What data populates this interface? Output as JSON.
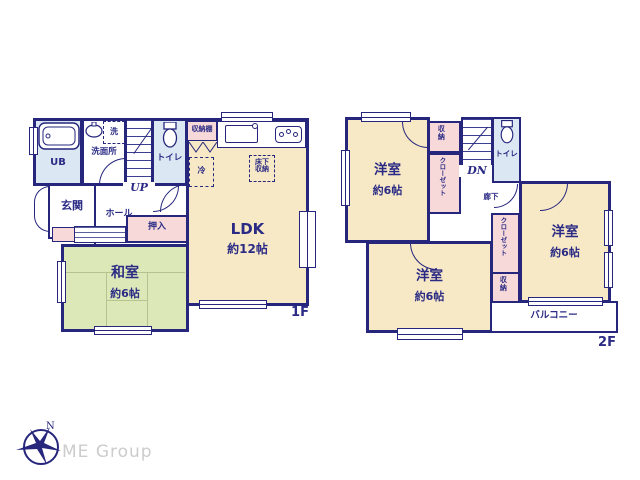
{
  "colors": {
    "wall_navy": "#26267d",
    "text_navy": "#2b2b85",
    "room_cream": "#f7e9c6",
    "tatami_green": "#dde8b9",
    "closet_pink": "#f7d9d9",
    "bath_blue": "#dbe8f4",
    "logo_gray": "#cccccc"
  },
  "floor1": {
    "floor_label": "1F",
    "rooms": {
      "ub": {
        "label": "UB"
      },
      "washroom": {
        "label": "洗面所"
      },
      "washer": {
        "label": "洗"
      },
      "toilet": {
        "label": "トイレ"
      },
      "stairs_label": "UP",
      "shelf": {
        "label": "収納棚"
      },
      "fridge": {
        "label": "冷"
      },
      "underfloor": {
        "line1": "床下",
        "line2": "収納"
      },
      "ldk": {
        "label": "LDK",
        "size": "約12帖"
      },
      "entrance": {
        "label": "玄関"
      },
      "hall": {
        "label": "ホール"
      },
      "oshiire": {
        "label": "押入"
      },
      "washitsu": {
        "label": "和室",
        "size": "約6帖"
      }
    }
  },
  "floor2": {
    "floor_label": "2F",
    "rooms": {
      "bedroom_nw": {
        "label": "洋室",
        "size": "約6帖"
      },
      "storage_top": {
        "label": "収納"
      },
      "closet_left": {
        "label": "クローゼット"
      },
      "stairs_label": "DN",
      "toilet": {
        "label": "トイレ"
      },
      "corridor": {
        "label": "廊下"
      },
      "bedroom_e": {
        "label": "洋室",
        "size": "約6帖"
      },
      "closet_mid": {
        "label": "クローゼット"
      },
      "storage_mid": {
        "label": "収納"
      },
      "bedroom_sw": {
        "label": "洋室",
        "size": "約6帖"
      },
      "balcony": {
        "label": "バルコニー"
      }
    }
  },
  "logo": {
    "text": "ME Group",
    "compass_letter": "N"
  }
}
